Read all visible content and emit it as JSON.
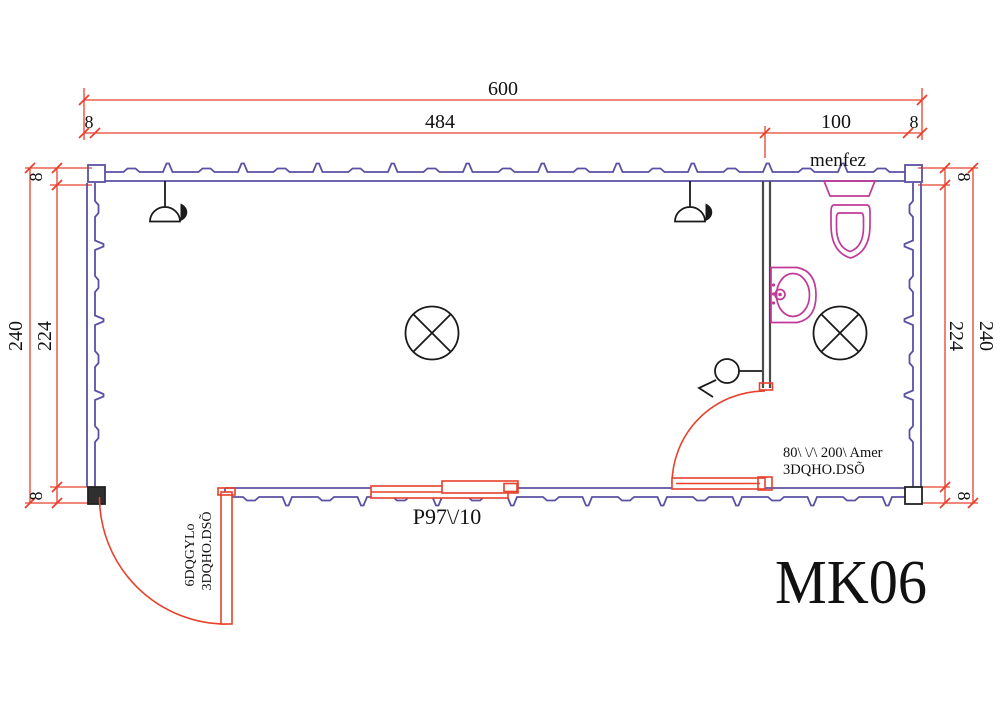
{
  "drawing": {
    "model_label": "MK06",
    "dimensions": {
      "top": {
        "total": "600",
        "wall_left": "8",
        "interior": "484",
        "wc": "100",
        "wall_right": "8"
      },
      "left": {
        "total": "240",
        "interior": "224",
        "wall_top": "8",
        "wall_bottom": "8"
      },
      "right": {
        "total": "240",
        "interior": "224",
        "wall_top": "8",
        "wall_bottom": "8"
      }
    },
    "labels": {
      "vent": "menfez",
      "window": "P97\\/10",
      "wc_door_line1": "80\\ \\/\\ 200\\ Amer",
      "wc_door_line2": "3DQHO.DSÕ",
      "entry_door_line1": "6DQGYLo",
      "entry_door_line2": "3DQHO.DSÕ"
    },
    "colors": {
      "wall": "#5a51a3",
      "dimension": "#e8402c",
      "fixture": "#c13a97",
      "partition": "#4a4a4a",
      "symbol": "#1a1a1a"
    },
    "icons": {
      "ceiling_light": "circle-with-x",
      "wall_lamp": "half-dome-with-flag",
      "switch": "circle-with-hook"
    }
  }
}
